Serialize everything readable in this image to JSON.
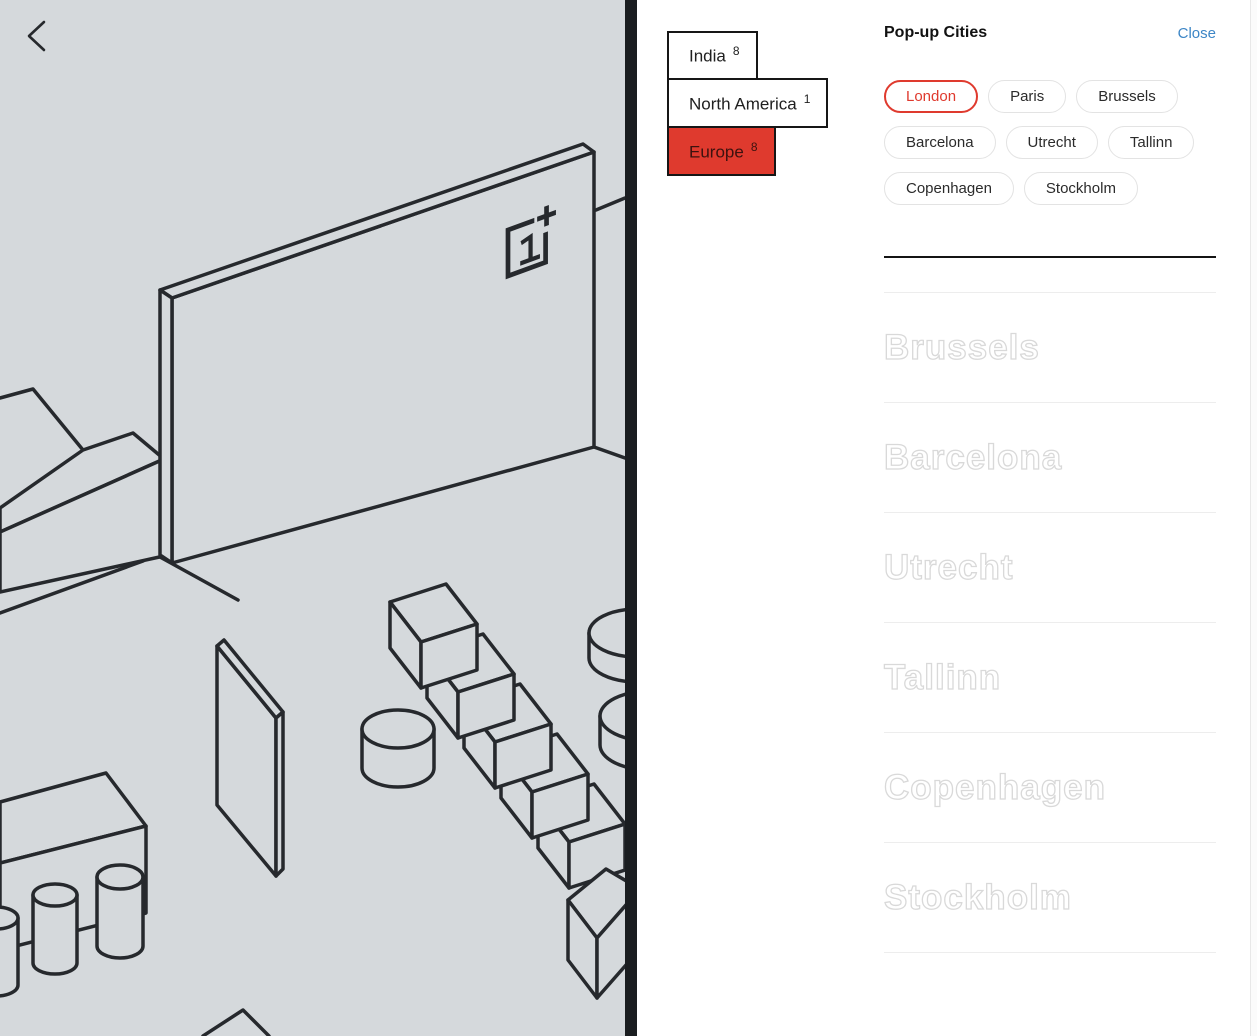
{
  "left_pane": {
    "icons": {
      "back": "back-chevron-icon",
      "logo": "oneplus-logo"
    },
    "description": "isometric line illustration of a pop-up store scene"
  },
  "region_selector": {
    "items": [
      {
        "label": "India",
        "count": "8",
        "selected": false
      },
      {
        "label": "North America",
        "count": "1",
        "selected": false
      },
      {
        "label": "Europe",
        "count": "8",
        "selected": true
      }
    ]
  },
  "panel": {
    "title": "Pop-up Cities",
    "close_label": "Close",
    "city_pills": [
      {
        "label": "London",
        "selected": true
      },
      {
        "label": "Paris",
        "selected": false
      },
      {
        "label": "Brussels",
        "selected": false
      },
      {
        "label": "Barcelona",
        "selected": false
      },
      {
        "label": "Utrecht",
        "selected": false
      },
      {
        "label": "Tallinn",
        "selected": false
      },
      {
        "label": "Copenhagen",
        "selected": false
      },
      {
        "label": "Stockholm",
        "selected": false
      }
    ],
    "city_list": [
      "Brussels",
      "Barcelona",
      "Utrecht",
      "Tallinn",
      "Copenhagen",
      "Stockholm"
    ]
  },
  "colors": {
    "accent_red": "#df3a2e",
    "link_blue": "#3d86c6",
    "canvas_gray": "#d5d9dc",
    "ink": "#26292d",
    "divider_dark": "#1a1d20"
  }
}
